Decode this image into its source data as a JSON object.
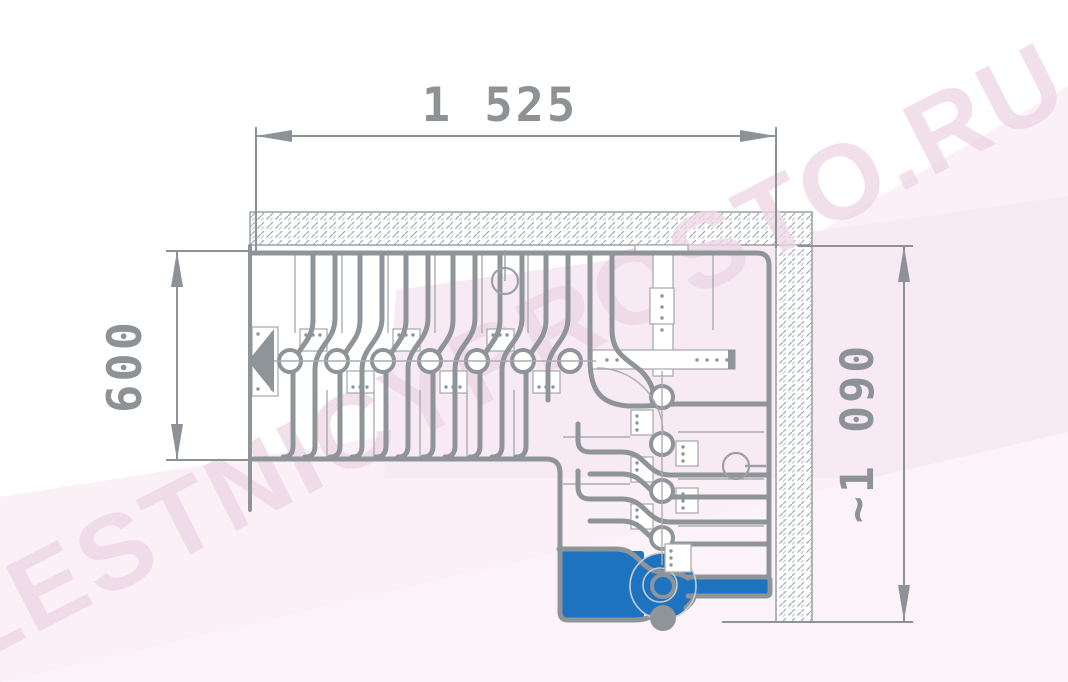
{
  "drawing": {
    "kind": "staircase-plan-top-view",
    "description": "L-shaped goose-step modular staircase plan with hatched walls, seven straight treads, quarter-turn, highlighted first step and support post",
    "straight_treads": 7,
    "turn_treads": 4,
    "first_step_highlighted": true
  },
  "dimensions": {
    "width": {
      "label": "1 525",
      "position": "top"
    },
    "depth": {
      "label": "600",
      "position": "left"
    },
    "side": {
      "label": "~1 090",
      "position": "right"
    }
  },
  "watermark": {
    "text": "LESTNICYPROSTO.RU"
  },
  "colors": {
    "line_gray": "#8f9499",
    "thin_gray": "#aaadb0",
    "hatch_gray": "#a6abaf",
    "dim_gray": "#8d9296",
    "step_blue": "#1e73c0",
    "bg_pink": "#faf0f6",
    "bg_pink_deep": "#f7eaf2",
    "watermark_pink": "#eed8e5"
  }
}
